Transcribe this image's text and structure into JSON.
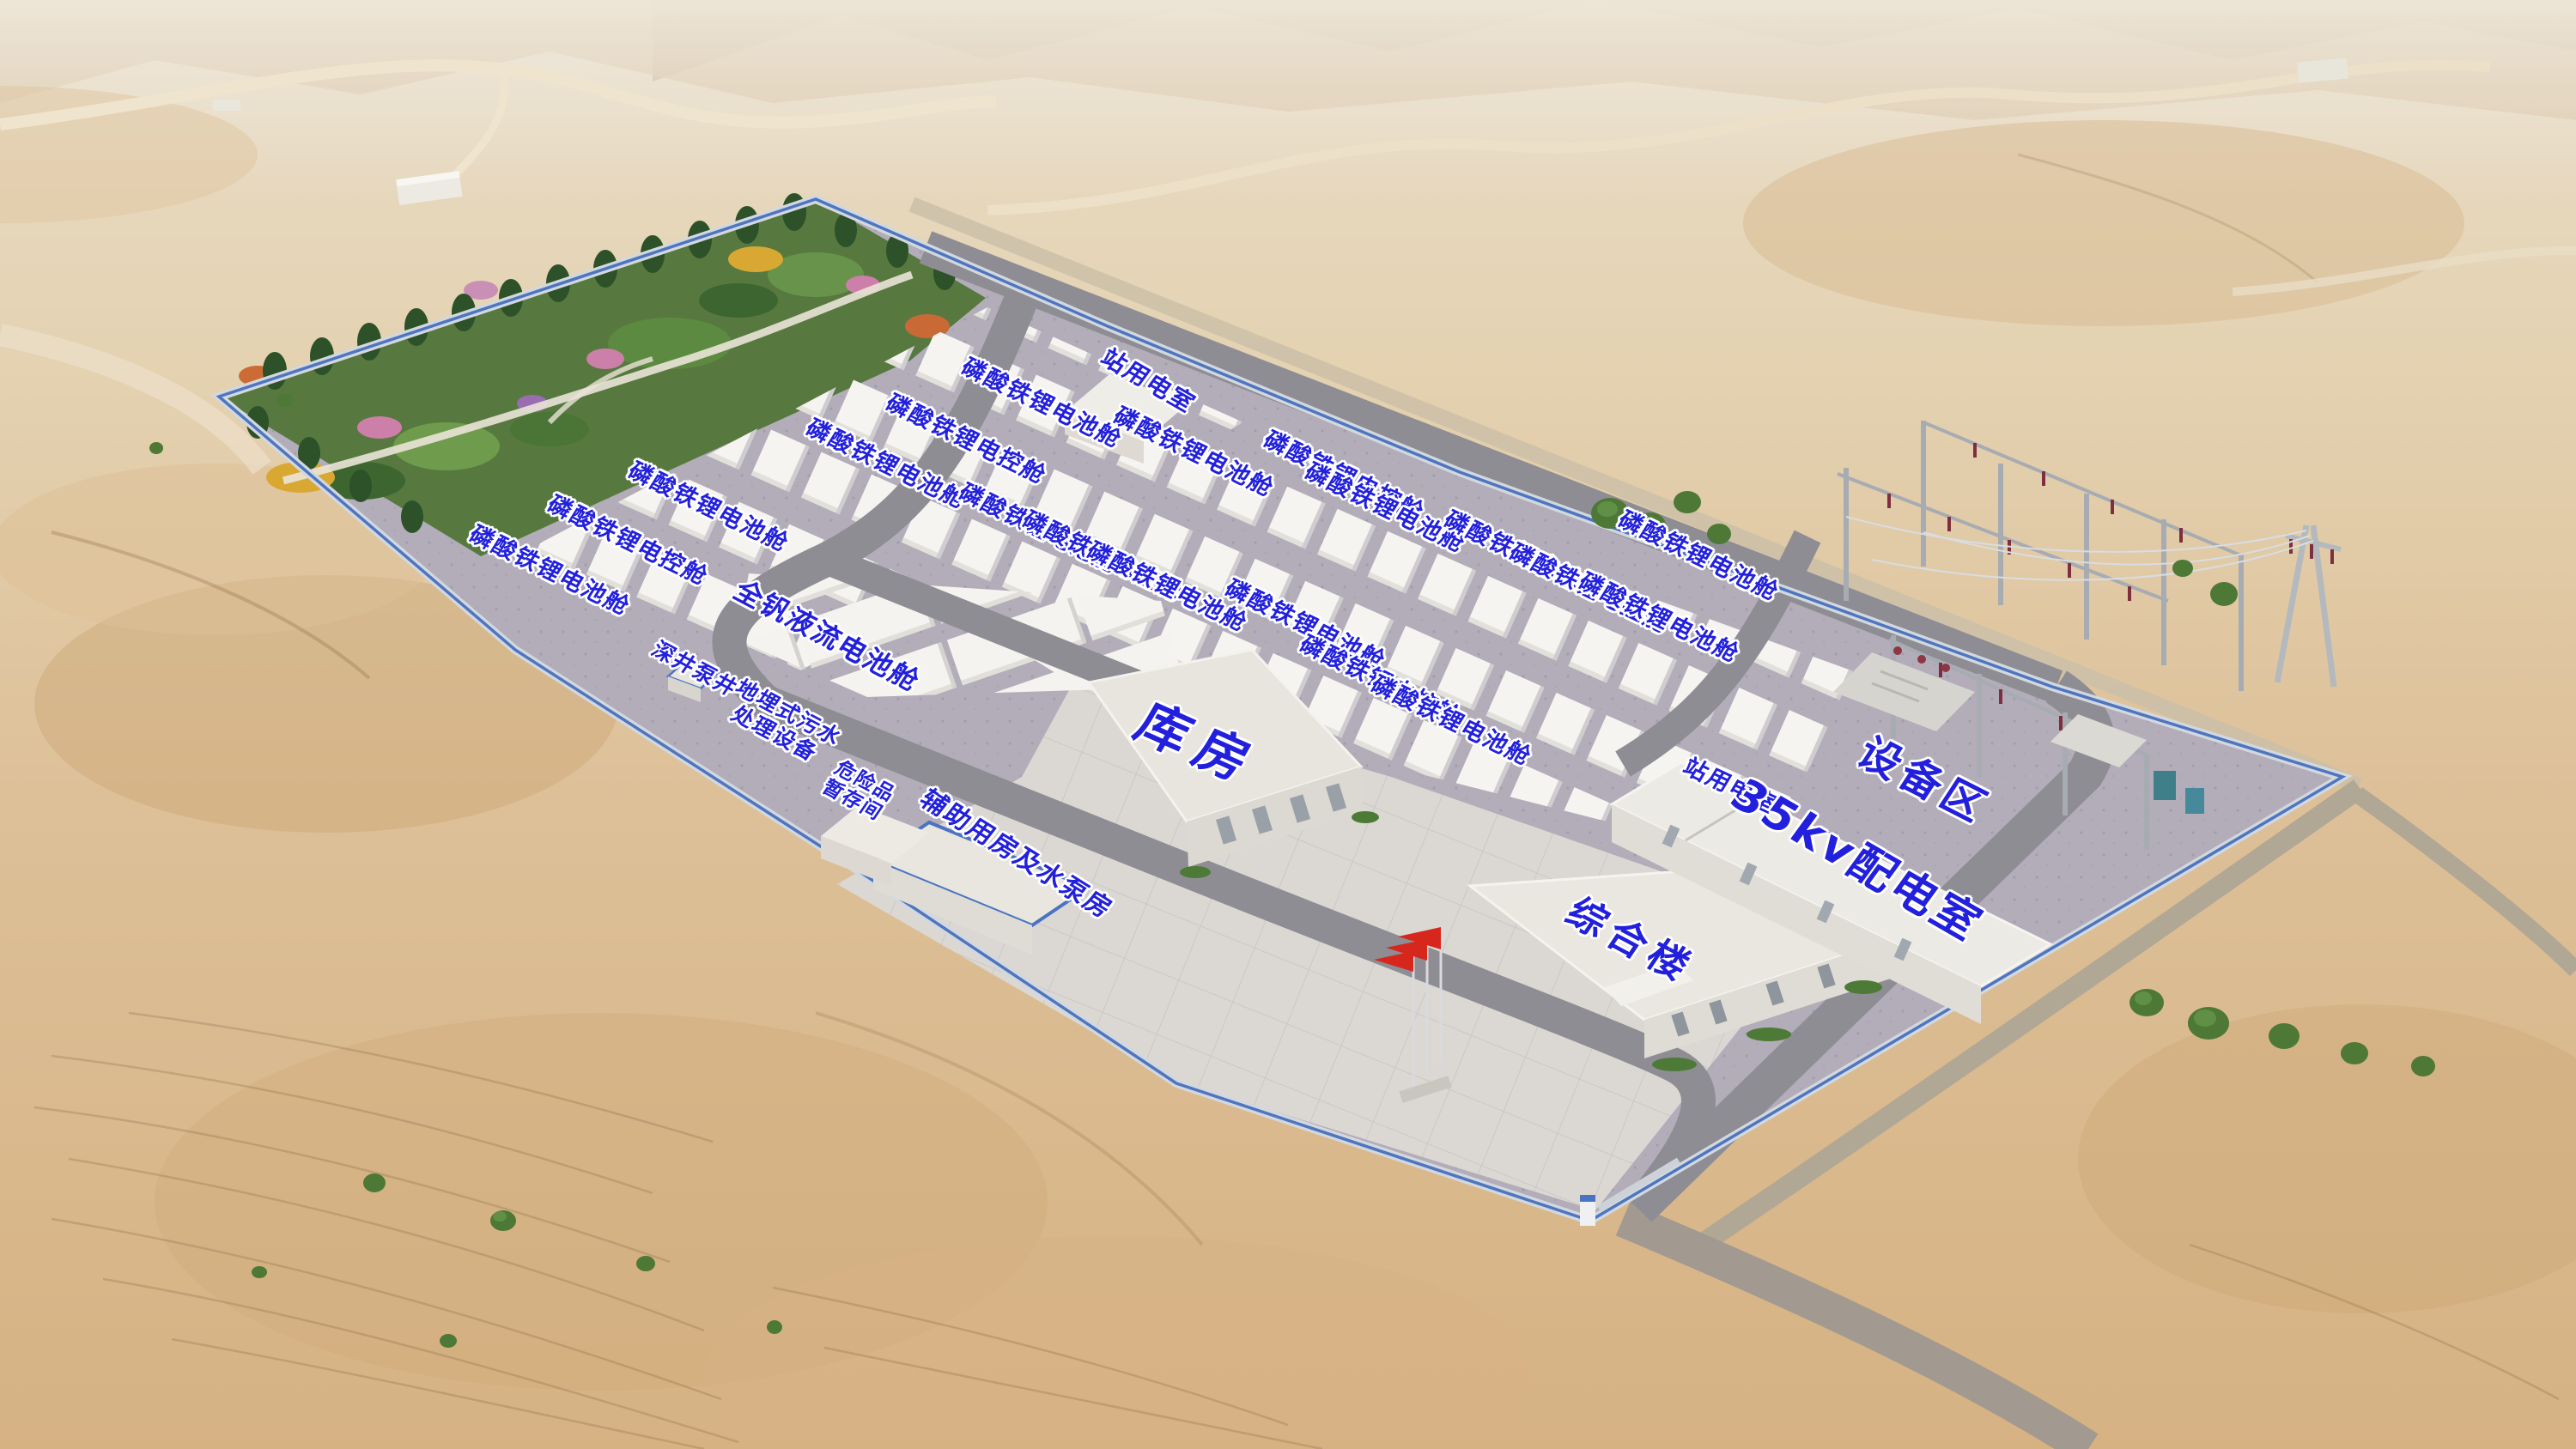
{
  "scene": {
    "description": "Aerial 3D rendering of a desert battery energy-storage power station with blue Chinese facility labels",
    "colors": {
      "label_blue": "#2220dd",
      "label_outline": "#ffffff",
      "desert_light": "#eadcc4",
      "desert_mid": "#ddc09a",
      "desert_deep": "#d3ac7c",
      "site_pad": "#b2adb9",
      "apron_tile": "#dbd8d3",
      "road_asphalt": "#8e8d94",
      "fence_blue": "#4e76c0",
      "container_white": "#f5f4f0",
      "garden_green": "#57793f",
      "flag_red": "#d7271d"
    }
  },
  "legend": {
    "battery_cabin": "磷酸铁锂电池舱",
    "control_cabin": "磷酸铁锂电控舱",
    "vanadium_flow_cabin": "全钒液流电池舱",
    "station_power_room": "站用电室",
    "warehouse": "库房",
    "distribution_room_35kv": "35kv配电室",
    "equipment_area": "设备区",
    "office_building": "综合楼",
    "auxiliary_pump_house": "辅助用房及水泵房",
    "deep_well_pump": "深井泵井",
    "buried_sewage_plant": "地埋式污水\n处理设备",
    "hazmat_storage": "危险品\n暂存间"
  },
  "annotations": [
    {
      "name": "battery-cabin-label",
      "text": "磷酸铁锂电池舱"
    },
    {
      "name": "station-power-room-north-label",
      "text": "站用电室"
    },
    {
      "name": "control-cabin-label",
      "text": "磷酸铁锂电控舱"
    },
    {
      "name": "battery-cabin-label",
      "text": "磷酸铁锂电池舱"
    },
    {
      "name": "battery-cabin-label",
      "text": "磷酸铁锂电池舱"
    },
    {
      "name": "control-cabin-label",
      "text": "磷酸铁锂电控舱"
    },
    {
      "name": "battery-cabin-label",
      "text": "磷酸铁锂电池舱"
    },
    {
      "name": "battery-cabin-label",
      "text": "磷酸铁锂电池舱"
    },
    {
      "name": "control-cabin-label",
      "text": "磷酸铁锂电控舱"
    },
    {
      "name": "battery-cabin-label",
      "text": "磷酸铁锂电池舱"
    },
    {
      "name": "battery-cabin-label",
      "text": "磷酸铁锂电池舱"
    },
    {
      "name": "control-cabin-label",
      "text": "磷酸铁锂电控舱"
    },
    {
      "name": "battery-cabin-label",
      "text": "磷酸铁锂电池舱"
    },
    {
      "name": "battery-cabin-label",
      "text": "磷酸铁锂电池舱"
    },
    {
      "name": "battery-cabin-label",
      "text": "磷酸铁锂电池舱"
    },
    {
      "name": "control-cabin-label",
      "text": "磷酸铁锂电控舱"
    },
    {
      "name": "battery-cabin-label",
      "text": "磷酸铁锂电池舱"
    },
    {
      "name": "battery-cabin-label",
      "text": "磷酸铁锂电池舱"
    },
    {
      "name": "control-cabin-label",
      "text": "磷酸铁锂电控舱"
    },
    {
      "name": "battery-cabin-label",
      "text": "磷酸铁锂电池舱"
    },
    {
      "name": "vanadium-flow-cabin-label",
      "text": "全钒液流电池舱"
    },
    {
      "name": "deep-well-pump-label",
      "text": "深井泵井"
    },
    {
      "name": "sewage-plant-label",
      "text": "地埋式污水\n处理设备"
    },
    {
      "name": "hazmat-storage-label",
      "text": "危险品\n暂存间"
    },
    {
      "name": "auxiliary-pump-house-label",
      "text": "辅助用房及水泵房"
    },
    {
      "name": "warehouse-label",
      "text": "库房"
    },
    {
      "name": "office-building-label",
      "text": "综合楼"
    },
    {
      "name": "station-power-room-south-label",
      "text": "站用电室"
    },
    {
      "name": "distribution-room-label",
      "text": "35kv配电室"
    },
    {
      "name": "equipment-area-label",
      "text": "设备区"
    }
  ]
}
